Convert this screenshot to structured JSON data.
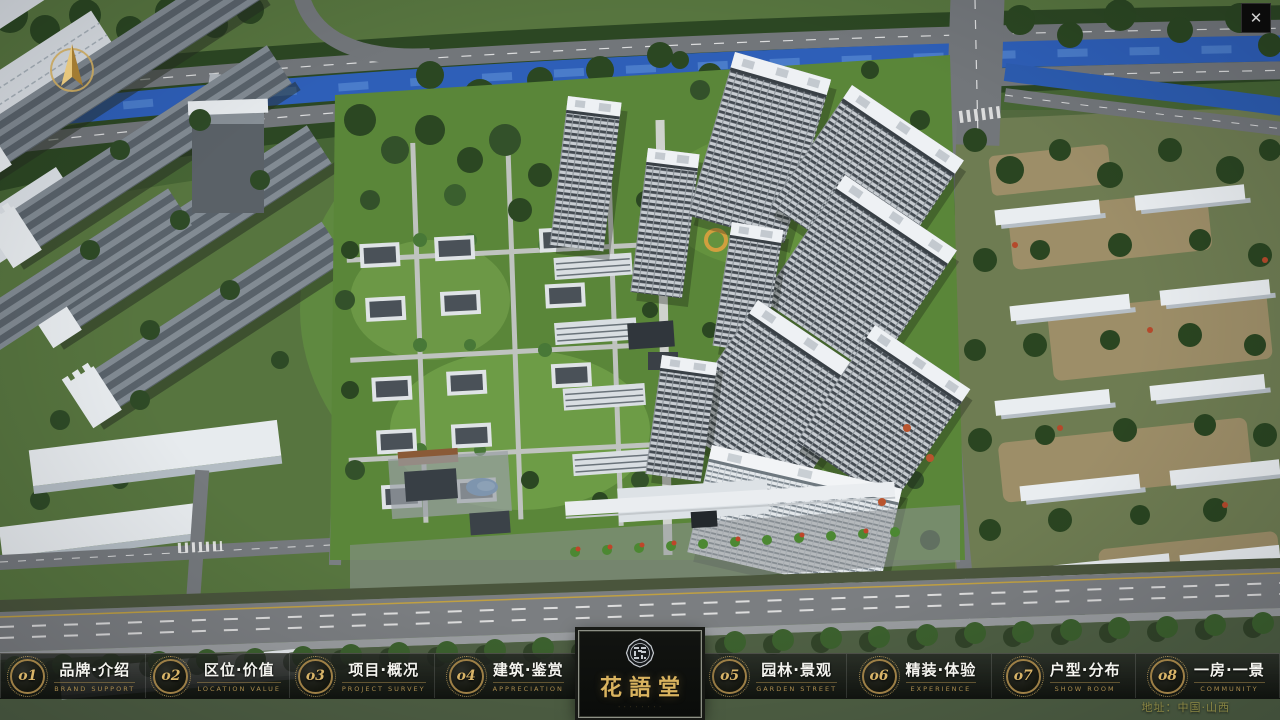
{
  "window": {
    "close_glyph": "✕"
  },
  "nav": {
    "items_left": [
      {
        "num": "o1",
        "label": "品牌·介绍",
        "sub": "BRAND SUPPORT"
      },
      {
        "num": "o2",
        "label": "区位·价值",
        "sub": "LOCATION VALUE"
      },
      {
        "num": "o3",
        "label": "项目·概况",
        "sub": "PROJECT SURVEY"
      },
      {
        "num": "o4",
        "label": "建筑·鉴赏",
        "sub": "APPRECIATION"
      }
    ],
    "items_right": [
      {
        "num": "o5",
        "label": "园林·景观",
        "sub": "GARDEN STREET"
      },
      {
        "num": "o6",
        "label": "精装·体验",
        "sub": "EXPERIENCE"
      },
      {
        "num": "o7",
        "label": "户型·分布",
        "sub": "SHOW ROOM"
      },
      {
        "num": "o8",
        "label": "一房·一景",
        "sub": "COMMUNITY"
      }
    ],
    "logo": {
      "title": "花語堂",
      "tagline_dots": "· · · · · · · ·"
    }
  },
  "footer": {
    "address": "地址：中国·山西"
  },
  "colors": {
    "accent_gold": "#c9a55c",
    "bar_background": "#101310",
    "river_blue": "#2e5fb8",
    "lawn_green": "#5a8639",
    "tower_facade": "#c7ccd1"
  }
}
